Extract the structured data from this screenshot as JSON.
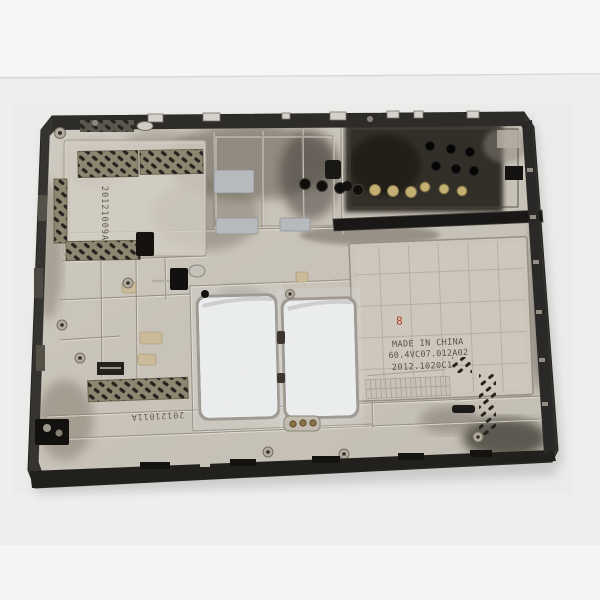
{
  "scene": {
    "description": "Used laptop bottom base cover (inside view) lying on white textured foam background",
    "stamps": {
      "made_in": "MADE IN CHINA",
      "part_number": "60.4VC07.012A02",
      "date_code": "2012.1020C1",
      "serial_side": "20121009A",
      "serial_bottom": "20121011A",
      "inspection_mark": "8"
    },
    "colors": {
      "background": "#f2f2f1",
      "rim_dark": "#2e2c29",
      "body_magnesium": "#c9c3b8",
      "body_highlight": "#dcd8cf",
      "soot": "#45403a",
      "black_zone": "#201d1a",
      "vent_base": "#8d8670",
      "vent_slot": "#26231f",
      "brass": "#c3b072",
      "foam_white": "#eef0f1",
      "stamp_ink": "#474339",
      "red_mark": "#b23a2c"
    }
  }
}
